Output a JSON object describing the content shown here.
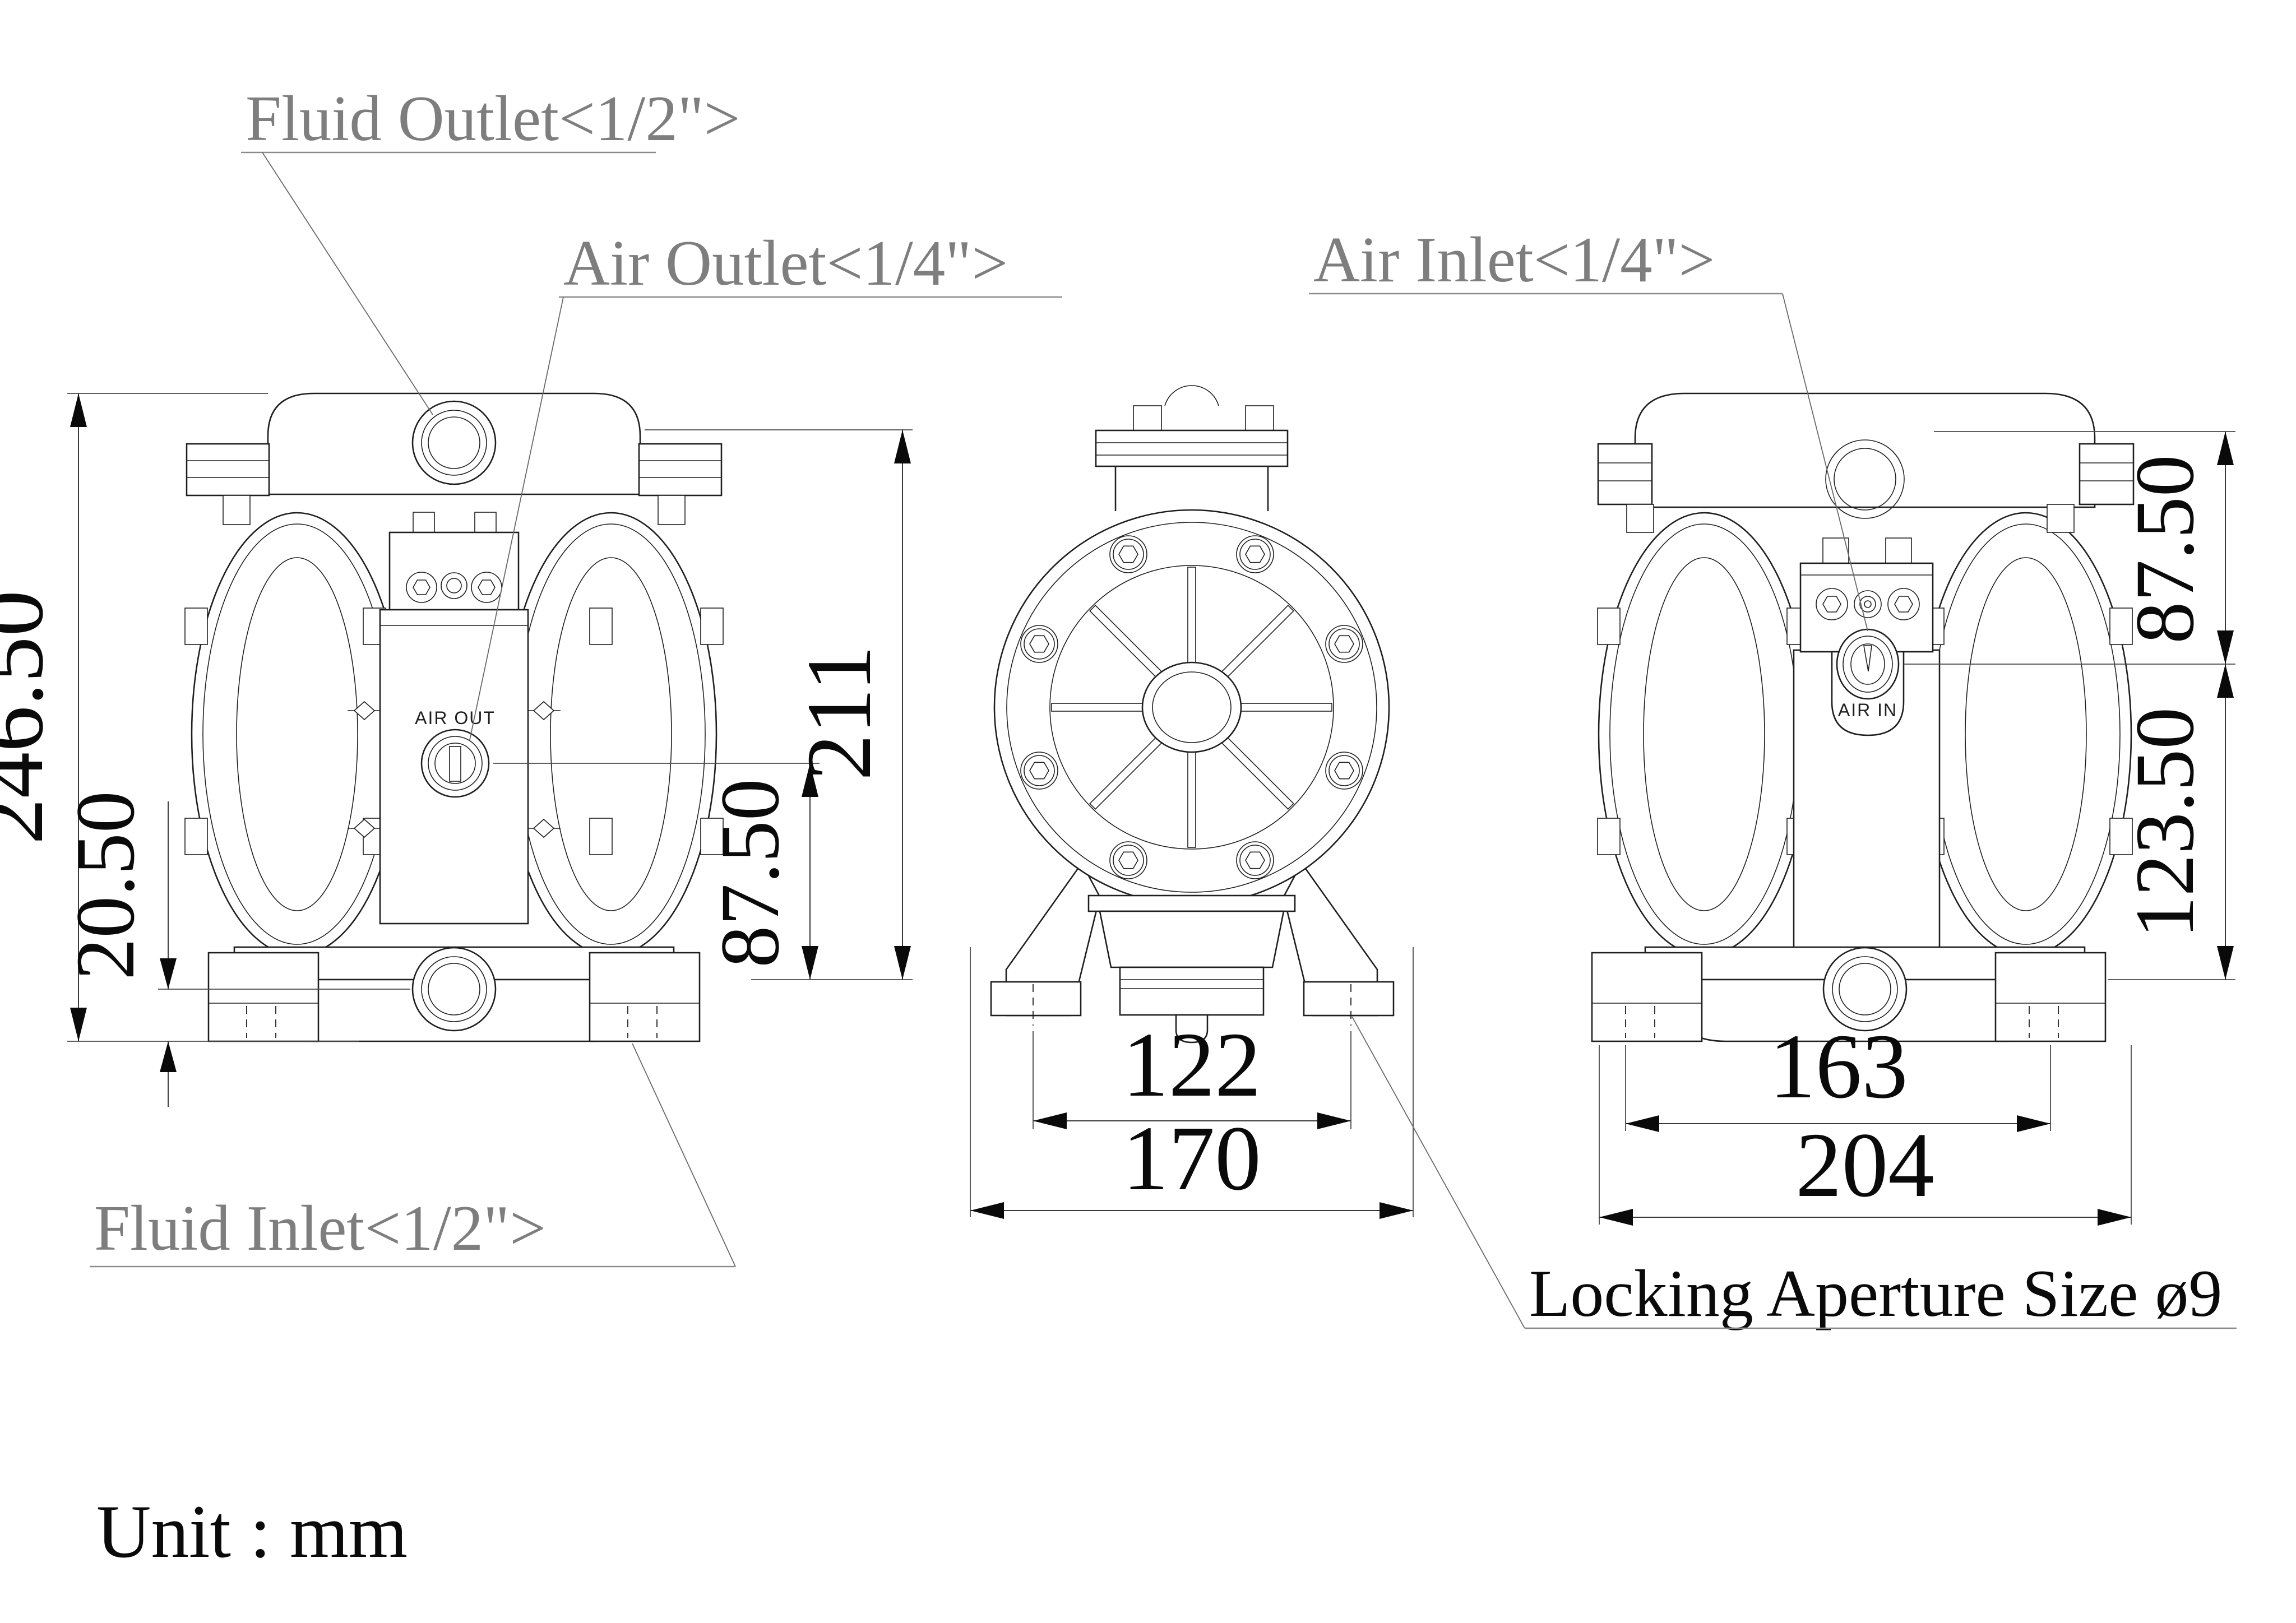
{
  "colors": {
    "line": "#1f1f1f",
    "dim_text": "#0a0a0a",
    "label_gray": "#7e7e7e"
  },
  "labels": {
    "fluid_outlet": "Fluid Outlet<1/2\">",
    "air_outlet": "Air Outlet<1/4\">",
    "air_inlet": "Air Inlet<1/4\">",
    "fluid_inlet": "Fluid Inlet<1/2\">",
    "locking_aperture": "Locking Aperture Size ø9"
  },
  "port_markings": {
    "air_out": "AIR OUT",
    "air_in": "AIR IN"
  },
  "dimensions_mm": {
    "total_height": "246.50",
    "inlet_centre_offset": "20.50",
    "air_out_to_base": "87.50",
    "flange_to_base": "211",
    "foot_slot_spacing": "122",
    "pump_depth": "170",
    "foot_bolt_spacing": "163",
    "pump_width": "204",
    "top_to_air_in": "87.50",
    "air_in_to_base": "123.50"
  },
  "footer": {
    "unit_note": "Unit : mm"
  }
}
